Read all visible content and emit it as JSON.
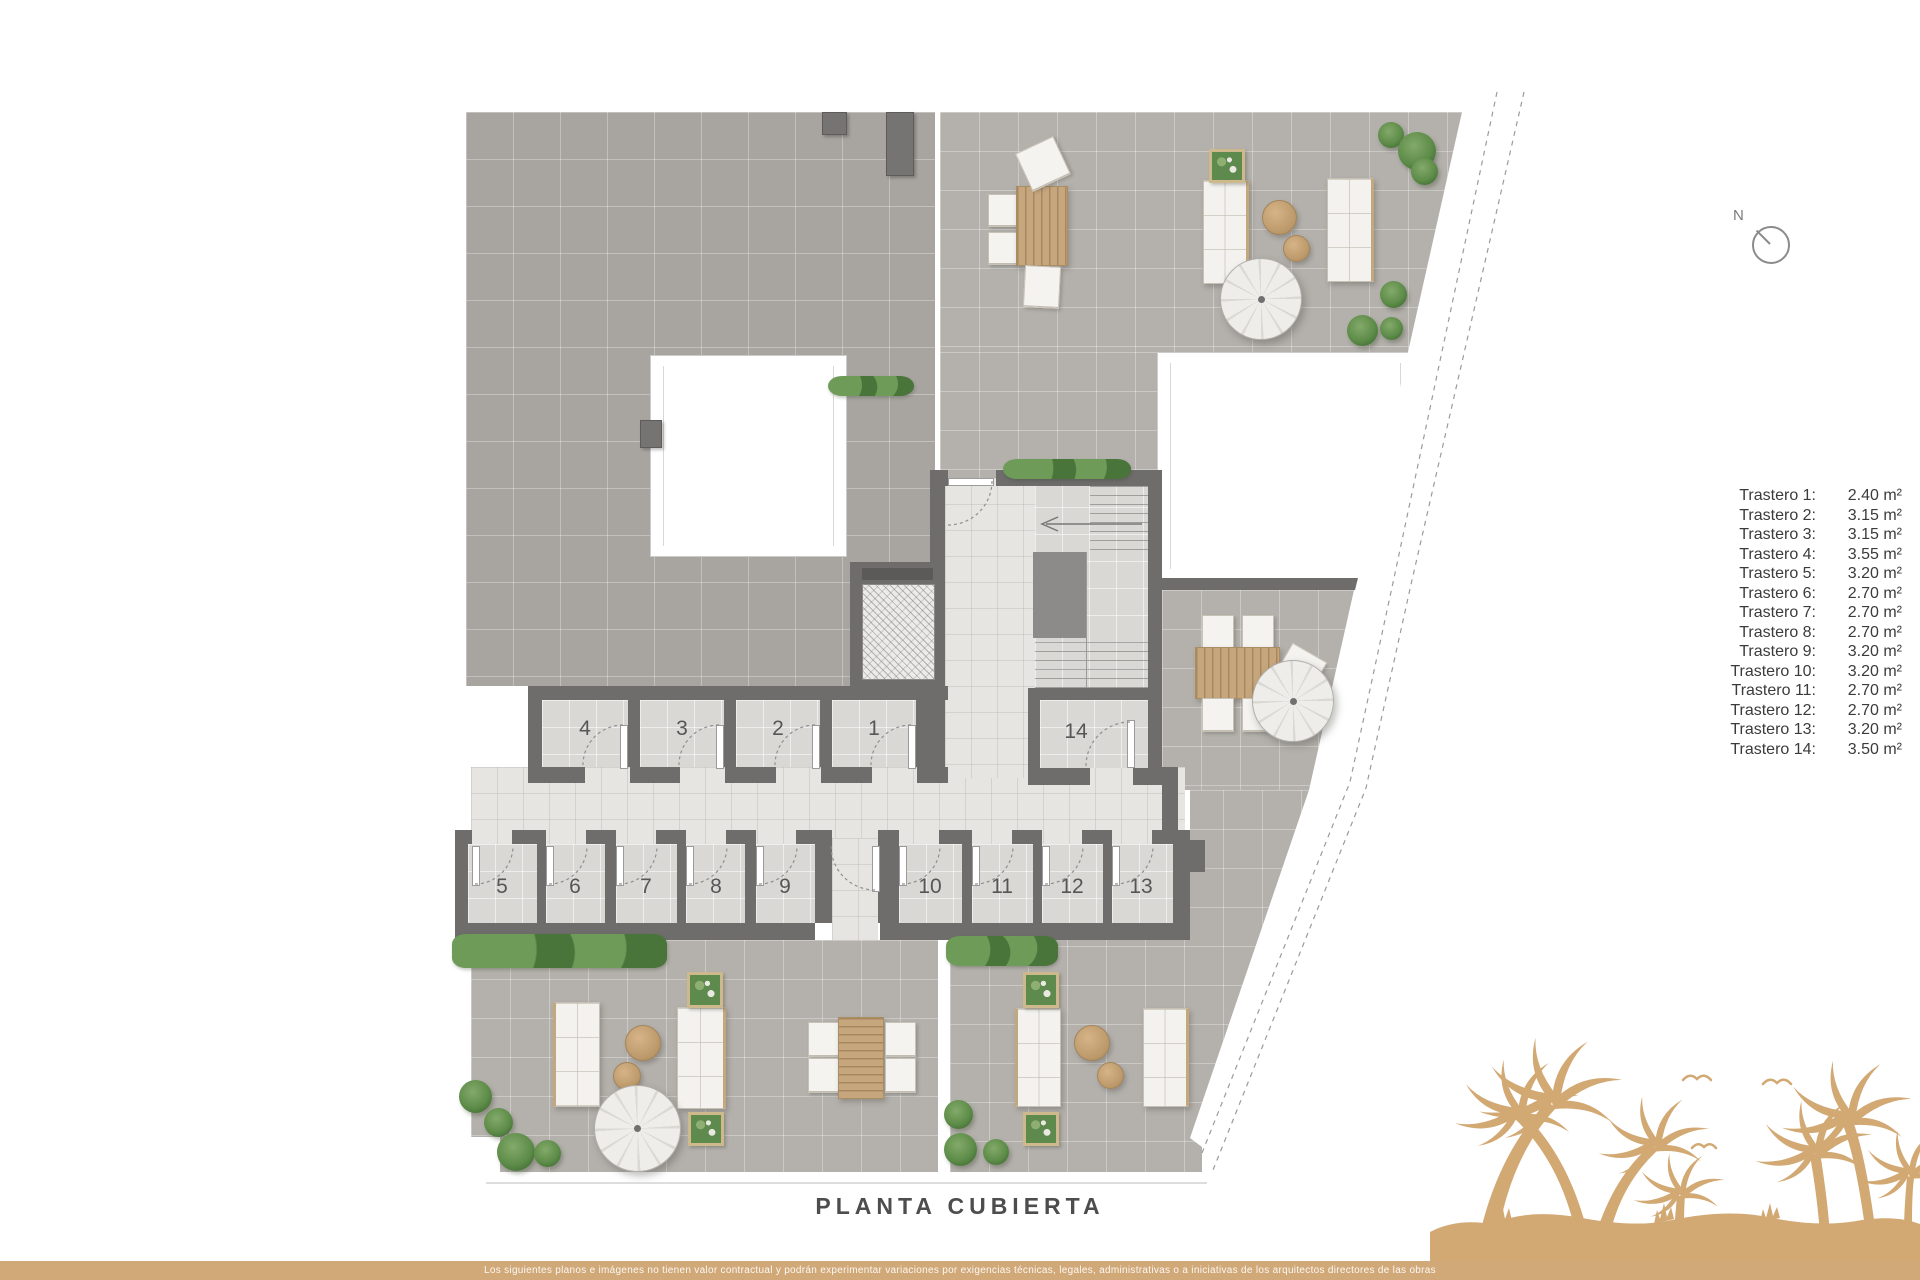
{
  "title": "PLANTA CUBIERTA",
  "north": {
    "label": "N"
  },
  "legend": {
    "items": [
      {
        "label": "Trastero 1:",
        "value": "2.40 m²"
      },
      {
        "label": "Trastero 2:",
        "value": "3.15 m²"
      },
      {
        "label": "Trastero 3:",
        "value": "3.15 m²"
      },
      {
        "label": "Trastero 4:",
        "value": "3.55 m²"
      },
      {
        "label": "Trastero 5:",
        "value": "3.20 m²"
      },
      {
        "label": "Trastero 6:",
        "value": "2.70 m²"
      },
      {
        "label": "Trastero 7:",
        "value": "2.70 m²"
      },
      {
        "label": "Trastero 8:",
        "value": "2.70 m²"
      },
      {
        "label": "Trastero 9:",
        "value": "3.20 m²"
      },
      {
        "label": "Trastero 10:",
        "value": "3.20 m²"
      },
      {
        "label": "Trastero 11:",
        "value": "2.70 m²"
      },
      {
        "label": "Trastero 12:",
        "value": "2.70 m²"
      },
      {
        "label": "Trastero 13:",
        "value": "3.20 m²"
      },
      {
        "label": "Trastero 14:",
        "value": "3.50 m²"
      }
    ]
  },
  "plan": {
    "storage_room_numbers": [
      "1",
      "2",
      "3",
      "4",
      "5",
      "6",
      "7",
      "8",
      "9",
      "10",
      "11",
      "12",
      "13",
      "14"
    ]
  },
  "footer": {
    "disclaimer": "Los siguientes planos e imágenes no tienen valor contractual y podrán experimentar variaciones por exigencias técnicas, legales, administrativas o a iniciativas de los arquitectos directores de las obras"
  },
  "colors": {
    "brand_tan": "#d2a873",
    "wall_gray": "#6e6d6b",
    "roof_tile": "#a8a5a0",
    "terrace_tile": "#b4b1ac",
    "room_tile": "#d9d8d4",
    "corridor_tile": "#e6e5e1",
    "plant_green": "#5e8c49",
    "legend_text": "#3b3b3b"
  }
}
